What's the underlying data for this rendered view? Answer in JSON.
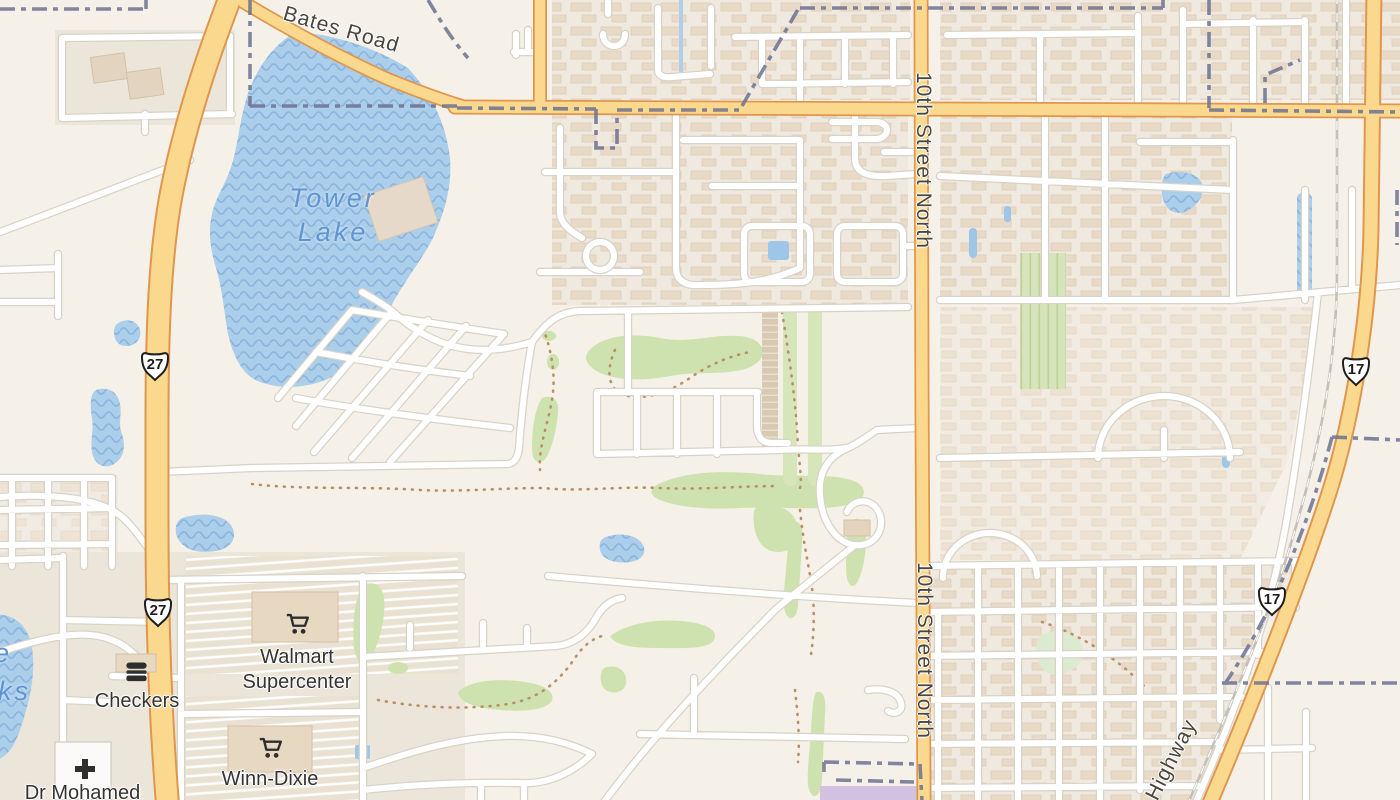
{
  "map": {
    "type": "street-map-tile-view",
    "labels": {
      "lake": {
        "line1": "Tower",
        "line2": "Lake"
      },
      "bates_road": "Bates Road",
      "street_10th_top": "10th Street North",
      "street_10th_bottom": "10th Street North",
      "highway_partial": "Highway",
      "water_label_fragment_top": "e",
      "water_label_fragment_bottom": "ks"
    },
    "route_shields": {
      "us27": "27",
      "us17": "17"
    },
    "pois": {
      "walmart": {
        "line1": "Walmart",
        "line2": "Supercenter",
        "icon": "shopping-cart"
      },
      "checkers": {
        "name": "Checkers",
        "icon": "burger"
      },
      "winn_dixie": {
        "name": "Winn-Dixie",
        "icon": "shopping-cart"
      },
      "dr_mohamed": {
        "name": "Dr Mohamed",
        "icon": "medical-cross"
      }
    },
    "colors": {
      "land": "#f5f1e8",
      "water": "#abceeb",
      "water_wave": "#8db5de",
      "golf_green": "#cee2af",
      "road_highway_fill": "#fad98e",
      "road_highway_casing": "#e0964e",
      "road_minor": "#ffffff",
      "boundary": "#6d7292",
      "military_area": "#d3c1e2",
      "water_label": "#5e95d2"
    }
  }
}
